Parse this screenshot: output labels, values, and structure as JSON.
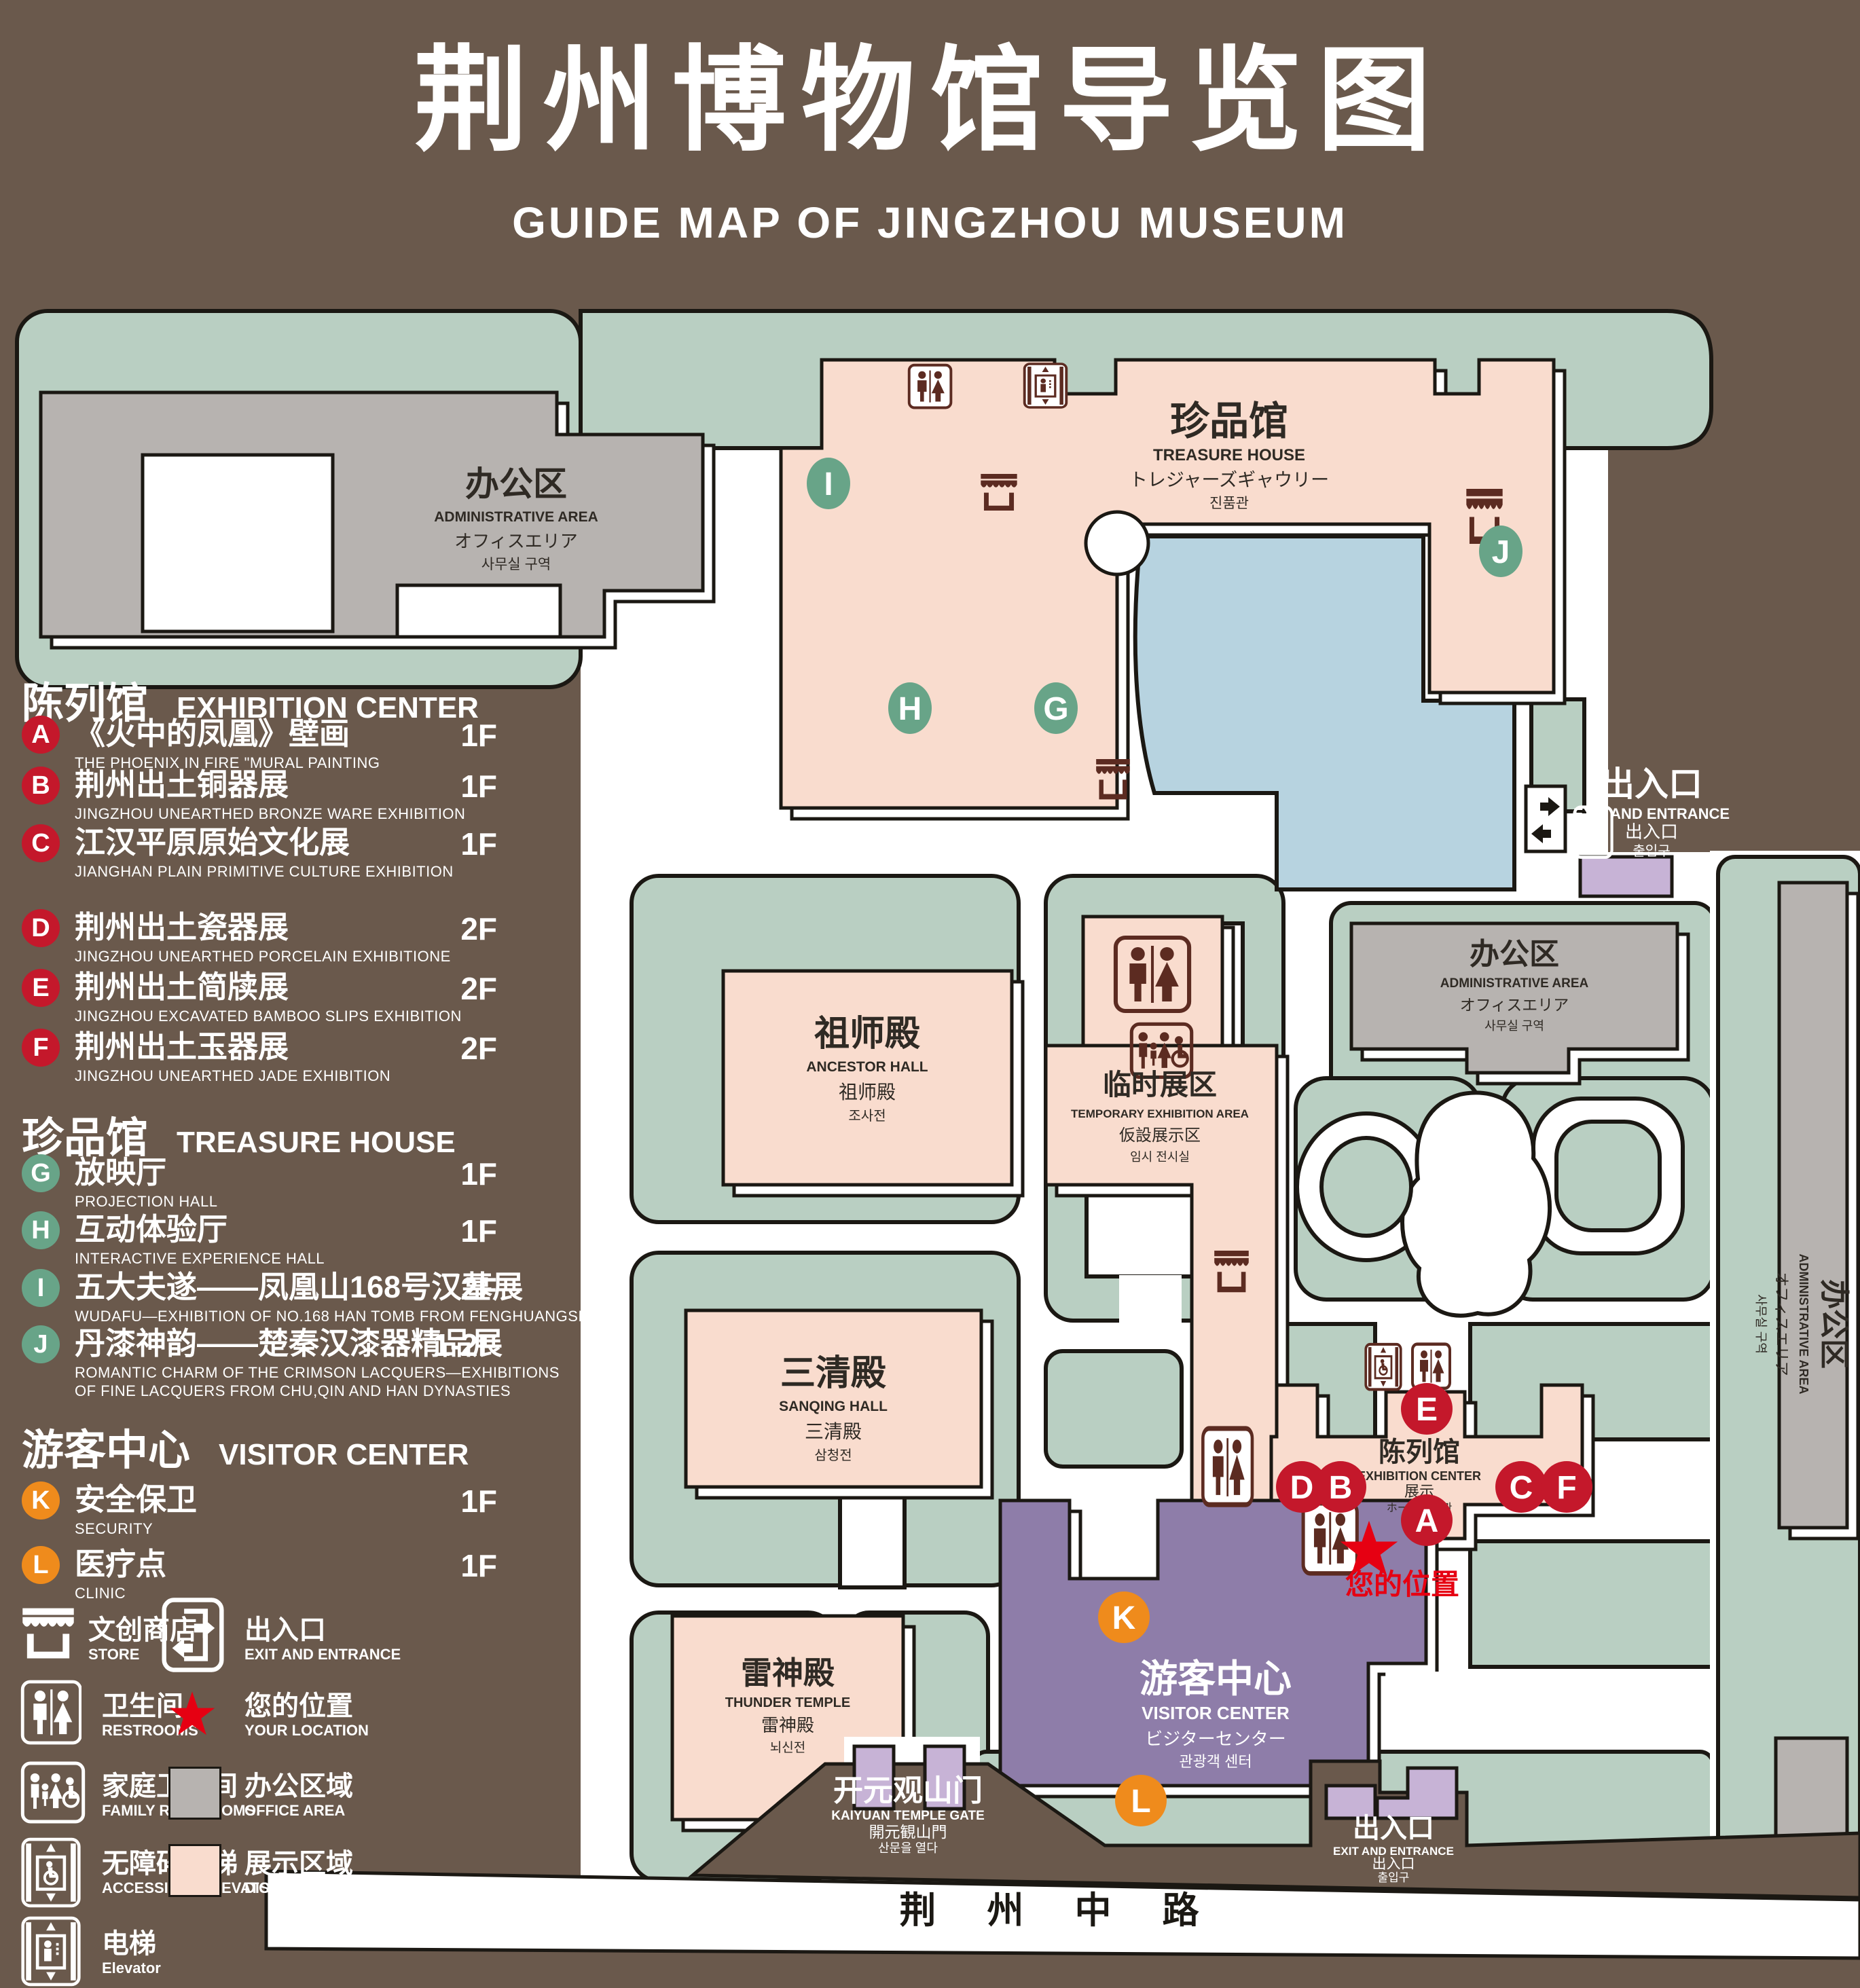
{
  "title": {
    "zh": "荆州博物馆导览图",
    "en": "GUIDE MAP OF JINGZHOU MUSEUM"
  },
  "legend": {
    "sections": [
      {
        "zh": "陈列馆",
        "en": "EXHIBITION CENTER",
        "items": [
          {
            "id": "A",
            "zh": "《火中的凤凰》壁画",
            "en": "THE PHOENIX IN FIRE \"MURAL PAINTING",
            "floor": "1F"
          },
          {
            "id": "B",
            "zh": "荆州出土铜器展",
            "en": "JINGZHOU UNEARTHED BRONZE WARE EXHIBITION",
            "floor": "1F"
          },
          {
            "id": "C",
            "zh": "江汉平原原始文化展",
            "en": "JIANGHAN PLAIN PRIMITIVE CULTURE EXHIBITION",
            "floor": "1F"
          },
          {
            "id": "D",
            "zh": "荆州出土瓷器展",
            "en": "JINGZHOU UNEARTHED PORCELAIN EXHIBITIONE",
            "floor": "2F"
          },
          {
            "id": "E",
            "zh": "荆州出土简牍展",
            "en": "JINGZHOU EXCAVATED BAMBOO SLIPS EXHIBITION",
            "floor": "2F"
          },
          {
            "id": "F",
            "zh": "荆州出土玉器展",
            "en": "JINGZHOU UNEARTHED JADE EXHIBITION",
            "floor": "2F"
          }
        ]
      },
      {
        "zh": "珍品馆",
        "en": "TREASURE HOUSE",
        "items": [
          {
            "id": "G",
            "zh": "放映厅",
            "en": "PROJECTION HALL",
            "floor": "1F"
          },
          {
            "id": "H",
            "zh": "互动体验厅",
            "en": "INTERACTIVE EXPERIENCE HALL",
            "floor": "1F"
          },
          {
            "id": "I",
            "zh": "五大夫遂——凤凰山168号汉墓展",
            "en": "WUDAFU—EXHIBITION OF NO.168 HAN TOMB FROM FENGHUANGSHAN",
            "floor": "2F"
          },
          {
            "id": "J",
            "zh": "丹漆神韵——楚秦汉漆器精品展",
            "en": "ROMANTIC CHARM OF THE CRIMSON LACQUERS—EXHIBITIONS",
            "en2": "OF FINE LACQUERS FROM CHU,QIN AND HAN DYNASTIES",
            "floor": "1-2F"
          }
        ]
      },
      {
        "zh": "游客中心",
        "en": "VISITOR CENTER",
        "items": [
          {
            "id": "K",
            "zh": "安全保卫",
            "en": "SECURITY",
            "floor": "1F"
          },
          {
            "id": "L",
            "zh": "医疗点",
            "en": "CLINIC",
            "floor": "1F"
          }
        ]
      }
    ],
    "symbols": [
      {
        "zh": "文创商店",
        "en": "STORE"
      },
      {
        "zh": "出入口",
        "en": "EXIT AND ENTRANCE"
      },
      {
        "zh": "卫生间",
        "en": "RESTROOMS"
      },
      {
        "zh": "您的位置",
        "en": "YOUR LOCATION"
      },
      {
        "zh": "家庭卫生间",
        "en": "FAMILY RESTROOMS"
      },
      {
        "zh": "办公区域",
        "en": "OFFICE AREA"
      },
      {
        "zh": "无障碍电梯",
        "en": "ACCESSIBLE ELEVATOR"
      },
      {
        "zh": "展示区域",
        "en": "DISPLAY AREA"
      },
      {
        "zh": "电梯",
        "en": "Elevator"
      }
    ]
  },
  "map": {
    "buildings": {
      "admin": {
        "zh": "办公区",
        "en": "ADMINISTRATIVE AREA",
        "jp": "オフィスエリア",
        "kr": "사무실 구역"
      },
      "treasure": {
        "zh": "珍品馆",
        "en": "TREASURE HOUSE",
        "jp": "トレジャーズギャウリー",
        "kr": "진품관"
      },
      "ancestor": {
        "zh": "祖师殿",
        "en": "ANCESTOR HALL",
        "jp": "祖师殿",
        "kr": "조사전"
      },
      "sanqing": {
        "zh": "三清殿",
        "en": "SANQING HALL",
        "jp": "三清殿",
        "kr": "삼청전"
      },
      "thunder": {
        "zh": "雷神殿",
        "en": "THUNDER TEMPLE",
        "jp": "雷神殿",
        "kr": "뇌신전"
      },
      "temporary": {
        "zh": "临时展区",
        "en": "TEMPORARY EXHIBITION AREA",
        "jp": "仮設展示区",
        "kr": "임시 전시실"
      },
      "exhibition": {
        "zh": "陈列馆",
        "en": "EXHIBITION CENTER",
        "jp": "展示",
        "kr": "ホール 진열관"
      },
      "visitor": {
        "zh": "游客中心",
        "en": "VISITOR CENTER",
        "jp": "ビジターセンター",
        "kr": "관광객 센터"
      },
      "gate": {
        "zh": "开元观山门",
        "en": "KAIYUAN TEMPLE GATE",
        "jp": "開元観山門",
        "kr": "산문을 열다"
      },
      "exit": {
        "zh": "出入口",
        "en": "EXIT AND ENTRANCE",
        "jp": "出入口",
        "kr": "출입구"
      }
    },
    "road": "荆 州 中 路",
    "your_location": "您的位置",
    "markers": {
      "A": "A",
      "B": "B",
      "C": "C",
      "D": "D",
      "E": "E",
      "F": "F",
      "G": "G",
      "H": "H",
      "I": "I",
      "J": "J",
      "K": "K",
      "L": "L"
    },
    "colors": {
      "background": "#6a594c",
      "ground": "#ffffff",
      "green": "#b9cfc2",
      "display_area": "#f9dcce",
      "office_area": "#b7b3b0",
      "pond": "#b7d3e0",
      "visitor_center": "#8e7da9",
      "lavender": "#c7b3d6",
      "icon": "#5c2b21",
      "marker_red": "#c4182b",
      "marker_green": "#68a488",
      "marker_orange": "#ef8b1c",
      "location_red": "#e60012"
    }
  }
}
